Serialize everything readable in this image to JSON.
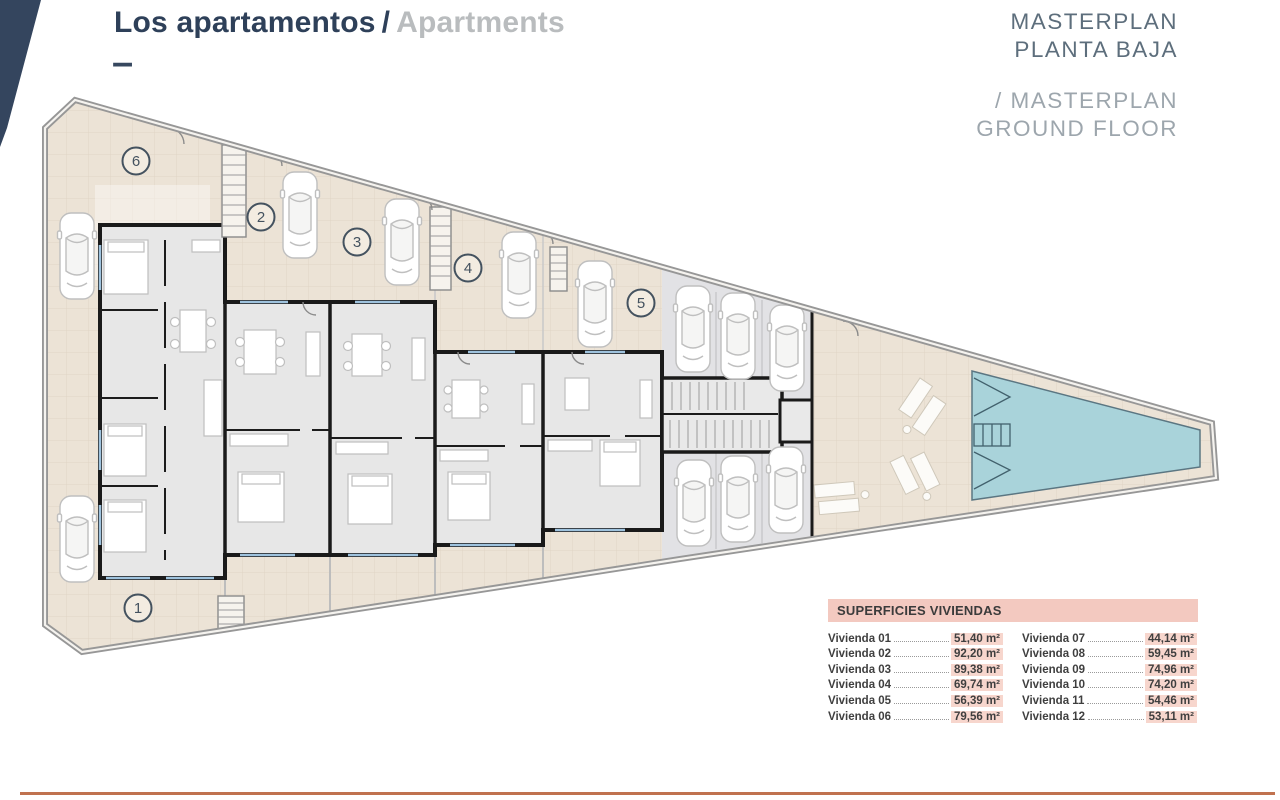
{
  "header": {
    "title_primary": "Los apartamentos",
    "title_separator": "/",
    "title_secondary": "Apartments",
    "dash": "–"
  },
  "plan_heading": {
    "line1_es": "MASTERPLAN",
    "line2_es": "PLANTA BAJA",
    "line1_en": "/ MASTERPLAN",
    "line2_en": "GROUND FLOOR"
  },
  "site_plan": {
    "units": [
      "1",
      "2",
      "3",
      "4",
      "5",
      "6"
    ]
  },
  "areas_table": {
    "title": "SUPERFICIES VIVIENDAS",
    "column_1": [
      {
        "label": "Vivienda 01",
        "value": "51,40 m²"
      },
      {
        "label": "Vivienda 02",
        "value": "92,20 m²"
      },
      {
        "label": "Vivienda 03",
        "value": "89,38 m²"
      },
      {
        "label": "Vivienda 04",
        "value": "69,74 m²"
      },
      {
        "label": "Vivienda 05",
        "value": "56,39 m²"
      },
      {
        "label": "Vivienda 06",
        "value": "79,56 m²"
      }
    ],
    "column_2": [
      {
        "label": "Vivienda 07",
        "value": "44,14 m²"
      },
      {
        "label": "Vivienda 08",
        "value": "59,45 m²"
      },
      {
        "label": "Vivienda 09",
        "value": "74,96 m²"
      },
      {
        "label": "Vivienda 10",
        "value": "74,20 m²"
      },
      {
        "label": "Vivienda 11",
        "value": "54,46 m²"
      },
      {
        "label": "Vivienda 12",
        "value": "53,11 m²"
      }
    ]
  },
  "colors": {
    "accent_navy": "#2e4059",
    "heading_gray": "#5d6e7c",
    "heading_light_gray": "#9da6ad",
    "table_header_bg": "#f3c9c0",
    "table_value_bg": "#f7d6cd",
    "terrace_beige": "#ece3d6",
    "parking_gray": "#e2e2e5",
    "pool_blue": "#a9d3da",
    "bottom_rule": "#c0724f"
  }
}
